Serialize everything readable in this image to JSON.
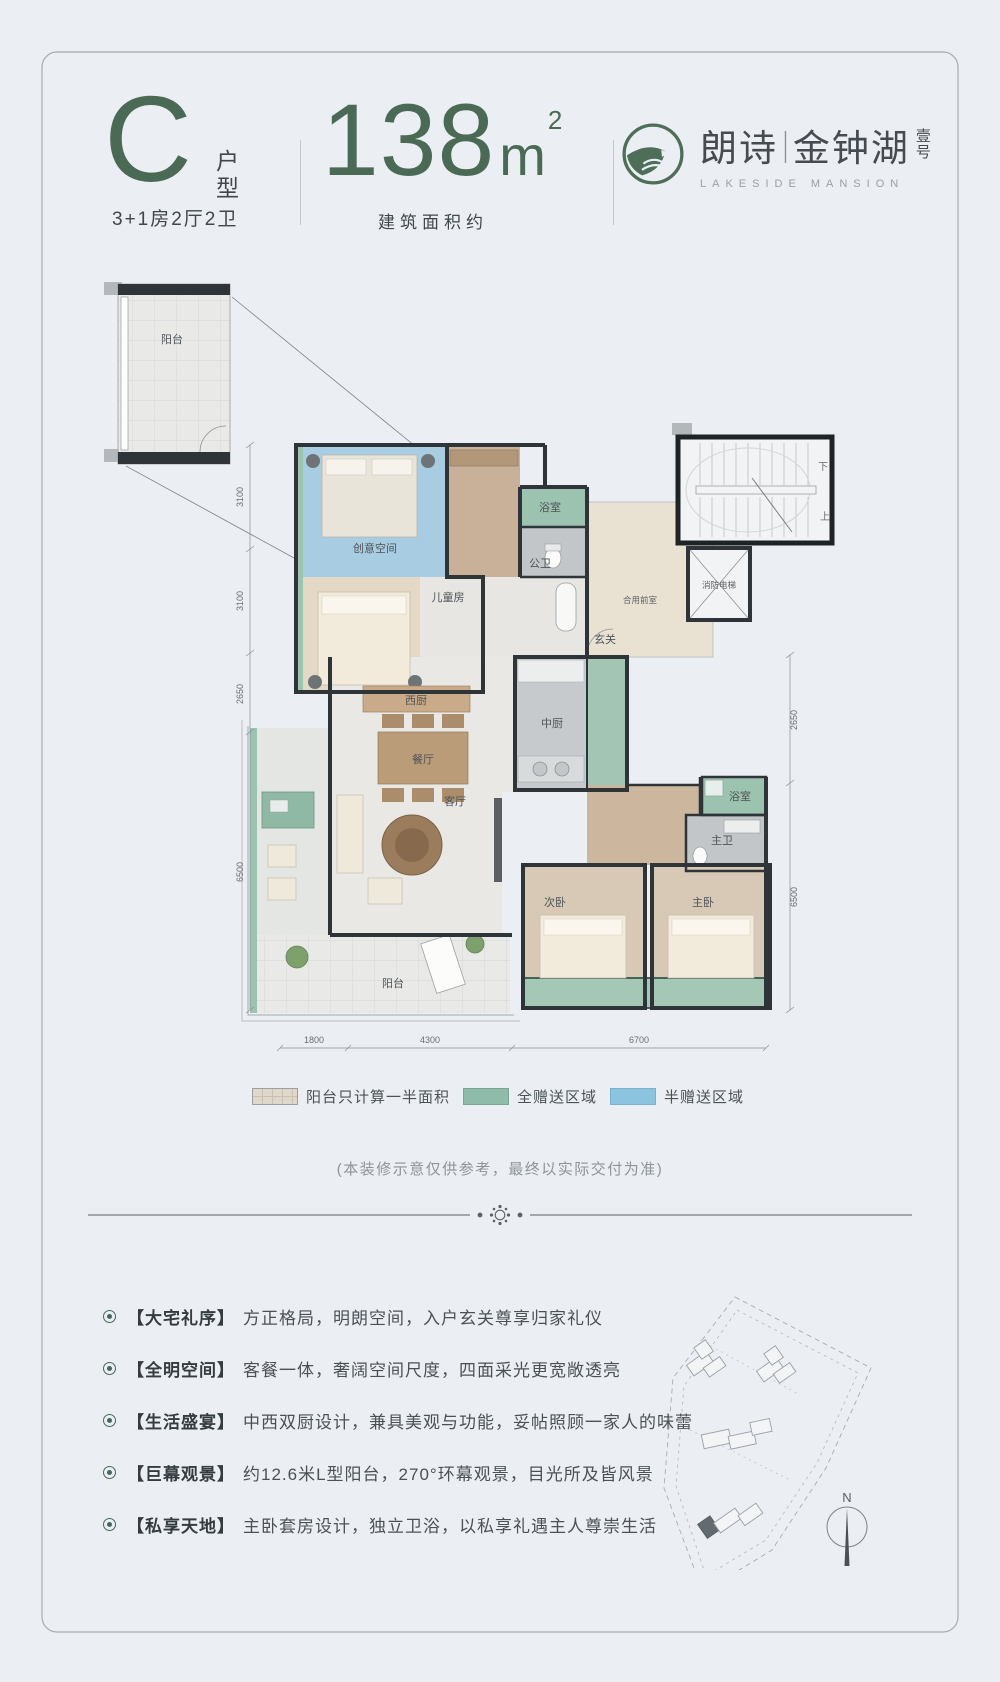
{
  "header": {
    "type_letter": "C",
    "type_label_chars": [
      "户",
      "型"
    ],
    "type_spec": "3+1房2厅2卫",
    "area_number": "138",
    "area_unit": "m",
    "area_sup": "2",
    "area_caption": "建筑面积约",
    "brand": {
      "cn1": "朗诗",
      "sep": "|",
      "cn2": "金钟湖",
      "suffix_chars": [
        "壹",
        "号"
      ],
      "en": "LAKESIDE MANSION",
      "brand_color": "#4e6e59"
    }
  },
  "plan": {
    "rooms": {
      "inset_balcony": "阳台",
      "creative": "创意空间",
      "kids": "儿童房",
      "bath_top": "浴室",
      "public_wc": "公卫",
      "foyer": "玄关",
      "shared_lobby": "合用前室",
      "fire_elevator": "消防电梯",
      "stair_down": "下",
      "stair_up": "上",
      "west_kitchen": "西厨",
      "dining": "餐厅",
      "chinese_kitchen": "中厨",
      "bath_right": "浴室",
      "master_wc": "主卫",
      "living": "客厅",
      "second_bedroom": "次卧",
      "master_bedroom": "主卧",
      "balcony": "阳台"
    },
    "dims": {
      "left": [
        "3100",
        "3100",
        "2650",
        "6500"
      ],
      "right": [
        "2650",
        "6500"
      ],
      "bottom": [
        "1800",
        "4300",
        "6700"
      ]
    },
    "colors": {
      "full_gift_area": "#9cc2b0",
      "half_gift_area": "#a8cde3",
      "wall": "#2e3438"
    }
  },
  "legend": {
    "items": [
      {
        "label": "阳台只计算一半面积",
        "swatch": "balcony-tile",
        "color": "#ded7ca"
      },
      {
        "label": "全赠送区域",
        "swatch": "full-gift",
        "color": "#8fbcaa"
      },
      {
        "label": "半赠送区域",
        "swatch": "half-gift",
        "color": "#8cc3de"
      }
    ]
  },
  "note": {
    "text": "(本装修示意仅供参考，最终以实际交付为准)"
  },
  "features": [
    {
      "tag": "【大宅礼序】",
      "desc": "方正格局，明朗空间，入户玄关尊享归家礼仪"
    },
    {
      "tag": "【全明空间】",
      "desc": "客餐一体，奢阔空间尺度，四面采光更宽敞透亮"
    },
    {
      "tag": "【生活盛宴】",
      "desc": "中西双厨设计，兼具美观与功能，妥帖照顾一家人的味蕾"
    },
    {
      "tag": "【巨幕观景】",
      "desc": "约12.6米L型阳台，270°环幕观景，目光所及皆风景"
    },
    {
      "tag": "【私享天地】",
      "desc": "主卧套房设计，独立卫浴，以私享礼遇主人尊崇生活"
    }
  ],
  "compass": {
    "north": "N"
  }
}
